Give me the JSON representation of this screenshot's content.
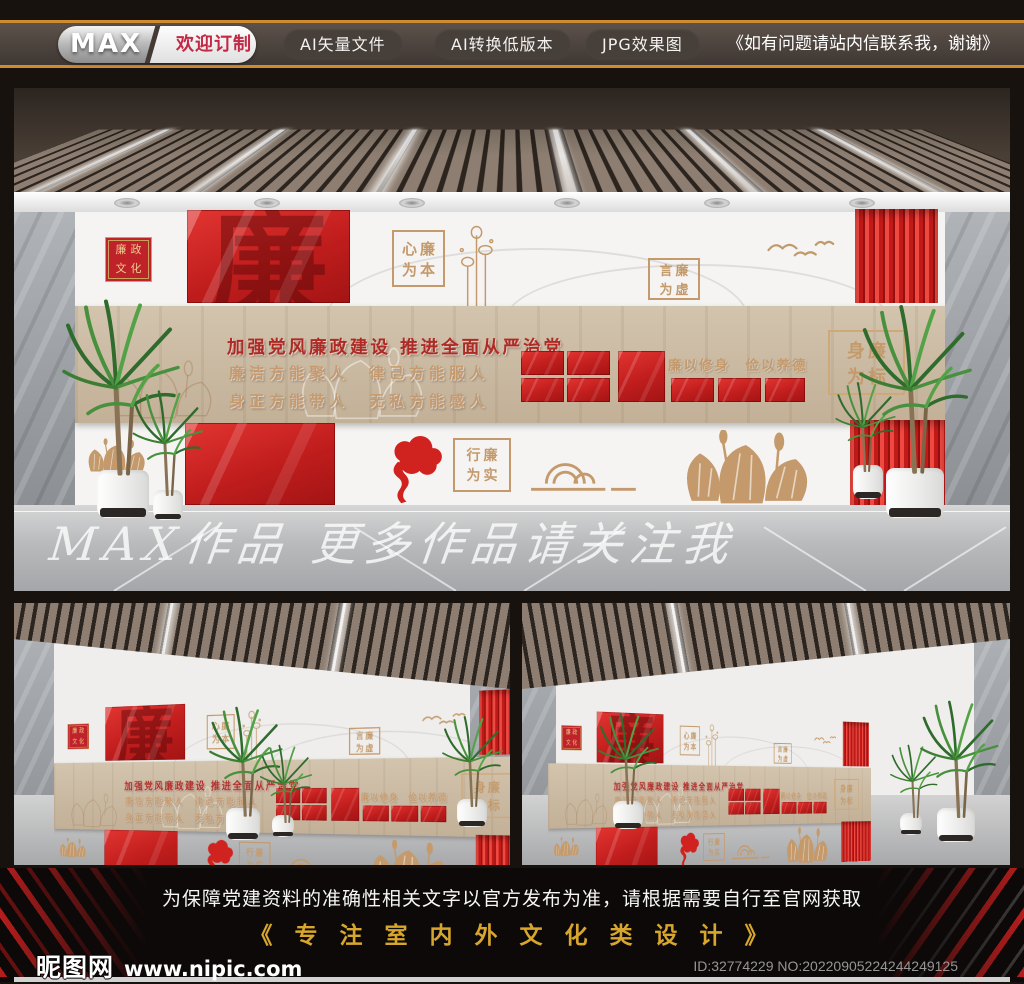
{
  "topbar": {
    "brand": "MAX",
    "tagline": "欢迎订制",
    "buttons": [
      "AI矢量文件",
      "AI转换低版本",
      "JPG效果图"
    ],
    "note": "《如有问题请站内信联系我，谢谢》"
  },
  "wall": {
    "badge": {
      "line1": "廉政",
      "line2": "文化"
    },
    "glass_char": "廉",
    "title": "加强党风廉政建设  推进全面从严治党",
    "slogan_line1": "廉洁方能聚人　律己方能服人",
    "slogan_line2": "身正方能带人　无私方能感人",
    "glass_caption": "廉以修身　俭以养德",
    "frames": {
      "xin": {
        "line1": "心廉",
        "line2": "为本"
      },
      "yan": {
        "line1": "言廉",
        "line2": "为虚"
      },
      "shen": {
        "line1": "身廉",
        "line2": "为标"
      },
      "xing": {
        "line1": "行廉",
        "line2": "为实"
      }
    }
  },
  "watermark": "MAX作品  更多作品请关注我",
  "footer": {
    "disclaimer": "为保障党建资料的准确性相关文字以官方发布为准，请根据需要自行至官网获取",
    "slogan": "《 专 注 室 内 外 文 化 类 设 计 》",
    "site_name": "昵图网",
    "site_url": "www.nipic.com",
    "id_text": "ID:32774229 NO:20220905224244249125"
  },
  "colors": {
    "accent_red": "#d2251f",
    "gold": "#c49a6c",
    "wood": "#c9b8a0",
    "topbar_orange": "#cf8b2f",
    "footer_gold": "#d8a62c"
  }
}
